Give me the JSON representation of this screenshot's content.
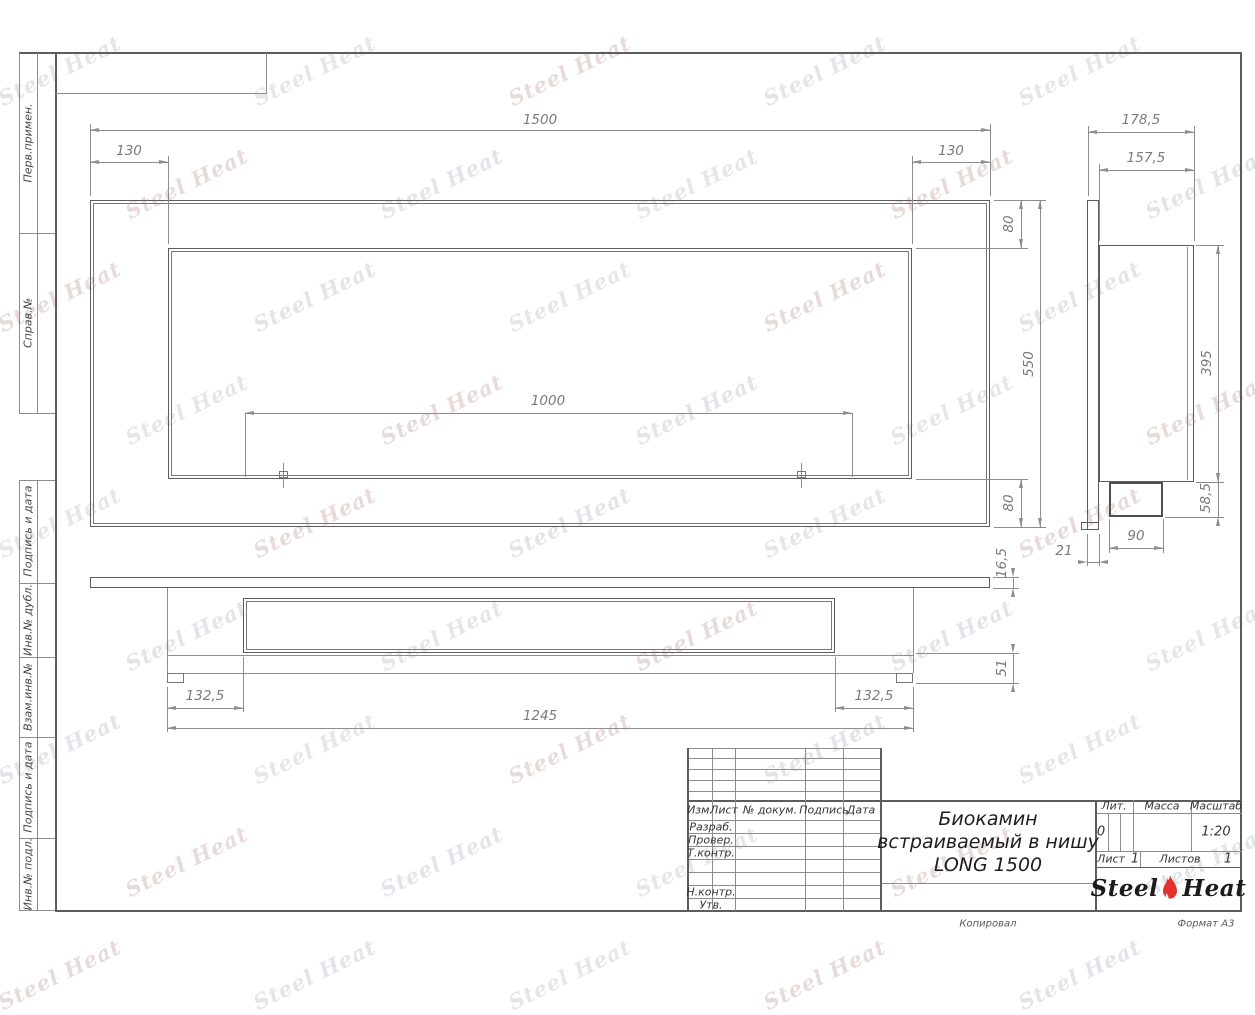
{
  "watermark": {
    "text": "Steel Heat"
  },
  "frame": {
    "sidebar": [
      {
        "label": "Перв.примен."
      },
      {
        "label": "Справ.№"
      },
      {
        "label": "Подпись и дата"
      },
      {
        "label": "Инв.№ дубл."
      },
      {
        "label": "Взам.инв.№"
      },
      {
        "label": "Подпись и дата"
      },
      {
        "label": "Инв.№ подл."
      }
    ],
    "footer": {
      "copied": "Копировал",
      "format": "Формат А3"
    }
  },
  "views": {
    "front": {
      "dims": {
        "width_total": "1500",
        "offset_left": "130",
        "offset_right": "130",
        "edge_top": "80",
        "height_total": "550",
        "edge_bottom": "80",
        "burner_span": "1000"
      }
    },
    "side": {
      "dims": {
        "depth_total": "178,5",
        "depth_inner": "157,5",
        "niche_height": "395",
        "box_height": "58,5",
        "box_width": "90",
        "flange_depth": "21"
      }
    },
    "bottom": {
      "dims": {
        "plate_thickness": "16,5",
        "bottom_height": "51",
        "offset_left": "132,5",
        "offset_right": "132,5",
        "body_width": "1245"
      }
    }
  },
  "title_block": {
    "revision_header": {
      "izm": "Изм.",
      "list": "Лист",
      "doc": "№ докум.",
      "sign": "Подпись",
      "date": "Дата"
    },
    "rows": {
      "developed": "Разраб.",
      "checked": "Провер.",
      "tcontrol": "Т.контр.",
      "ncontrol": "Н.контр.",
      "approved": "Утв."
    },
    "title_lines": {
      "l1": "Биокамин",
      "l2": "встраиваемый в нишу",
      "l3": "LONG 1500"
    },
    "lit": {
      "label": "Лит.",
      "value": "0"
    },
    "mass": {
      "label": "Масса"
    },
    "scale": {
      "label": "Масштаб",
      "value": "1:20"
    },
    "sheet": {
      "label": "Лист",
      "value": "1"
    },
    "sheets": {
      "label": "Листов",
      "value": "1"
    },
    "logo": {
      "word1": "Steel",
      "word2": "Heat"
    },
    "colors": {
      "flame_red": "#e5312b"
    }
  }
}
